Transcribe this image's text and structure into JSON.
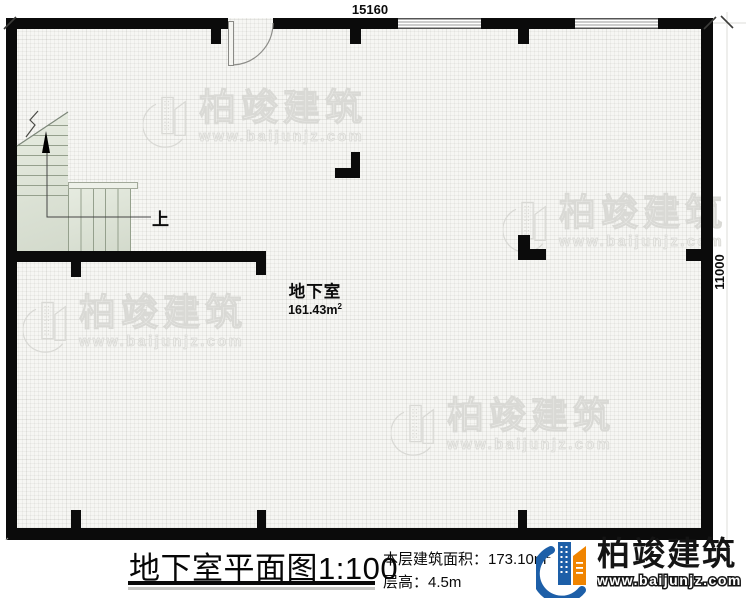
{
  "plan": {
    "dim_top": "15160",
    "dim_right": "11000",
    "room_name": "地下室",
    "room_area": "161.43m",
    "room_area_sup": "2",
    "stair_up_label": "上"
  },
  "footer": {
    "title": "地下室平面图1:100",
    "area_line": "本层建筑面积：173.10m",
    "area_sup": "2",
    "height_line": "层高：4.5m"
  },
  "brand": {
    "name": "柏竣建筑",
    "url": "www.baijunjz.com",
    "blue": "#1d5fa8",
    "orange": "#f08400"
  },
  "watermark": {
    "name": "柏竣建筑",
    "url": "www.baijunjz.com",
    "color": "#d9d9d5"
  },
  "colors": {
    "wall": "#0b0b0b",
    "floor_bg": "#f6f6f3",
    "stair_fill": "#dde3d6"
  }
}
